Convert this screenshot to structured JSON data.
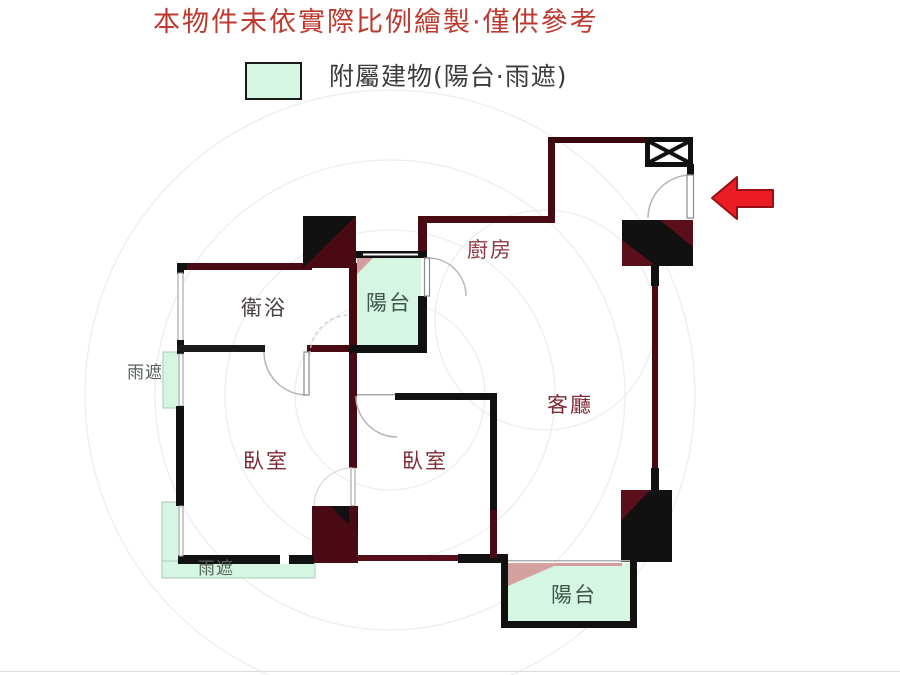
{
  "disclaimer": {
    "text": "本物件未依實際比例繪製·僅供參考",
    "color": "#bd3a30"
  },
  "legend": {
    "swatch_color": "#d5f6e3",
    "label": "附屬建物(陽台·雨遮)"
  },
  "floorplan": {
    "rooms": {
      "bathroom": {
        "label": "衛浴"
      },
      "balcony_top": {
        "label": "陽台"
      },
      "kitchen": {
        "label": "廚房"
      },
      "living_room": {
        "label": "客廳"
      },
      "bedroom_left": {
        "label": "臥室"
      },
      "bedroom_middle": {
        "label": "臥室"
      },
      "balcony_bottom": {
        "label": "陽台"
      },
      "rain_shade_left": {
        "label": "雨遮"
      },
      "rain_shade_bottom": {
        "label": "雨遮"
      }
    },
    "symbols": {
      "window_shaft": "boxed-x-symbol",
      "entrance_arrow": "red-left-arrow"
    },
    "colors": {
      "accessory_fill": "#d5f6e3",
      "wall_dark": "#4a0a14",
      "wall_black": "#111111",
      "arrow_red": "#ec1c24",
      "shade_pink": "#d49c9c",
      "disclaimer_red": "#bd3a30"
    }
  }
}
